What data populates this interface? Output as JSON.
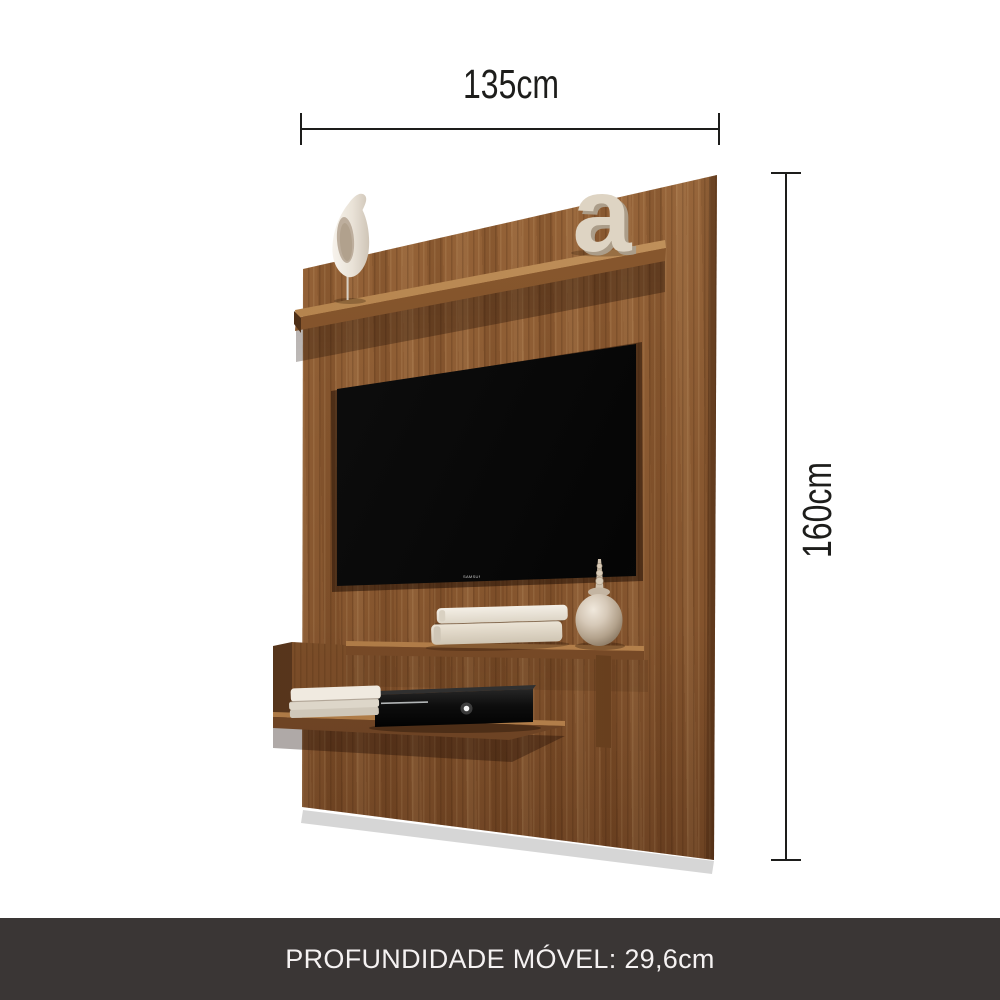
{
  "annotations": {
    "width_label": "135cm",
    "height_label": "160cm"
  },
  "footer": {
    "depth_label": "PROFUNDIDADE MÓVEL: 29,6cm",
    "background": "#3a3635",
    "text_color": "#f5f2f2"
  },
  "product": {
    "decor_letter": "a",
    "tv_logo": "SAMSUNG"
  },
  "colors": {
    "background": "#ffffff",
    "wood_light": "#a06c3e",
    "wood_mid": "#8d5c33",
    "wood_dark": "#6f4323",
    "dimension_line": "#1d1d1b",
    "tv_screen": "#0a0a0a",
    "decor_cream": "#ded4c3",
    "jar_metallic": "#c9bba8"
  },
  "icons": {
    "tv_logo_icon": "samsung-wordmark",
    "console_logo_icon": "xbox-power-sphere"
  }
}
